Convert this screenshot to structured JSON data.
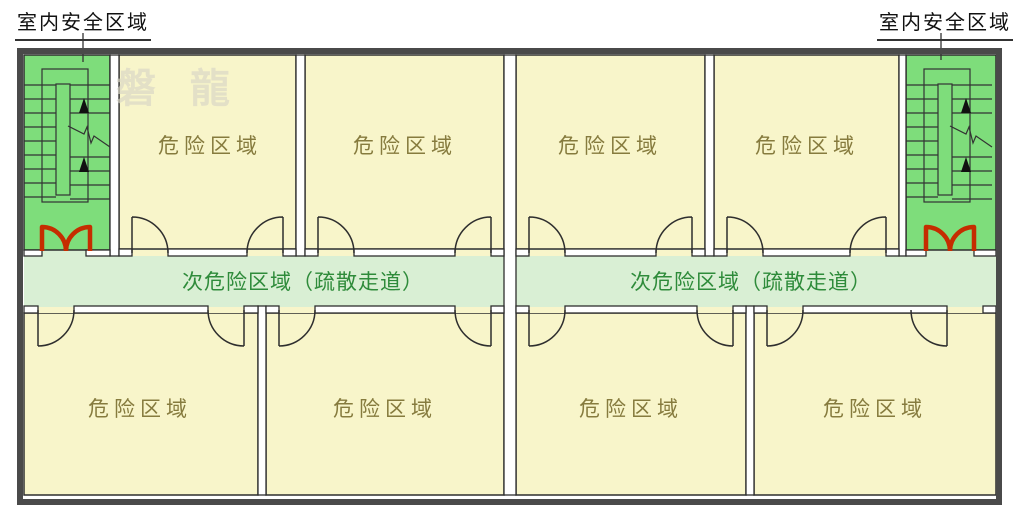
{
  "diagram": {
    "type": "evacuation-floor-plan",
    "watermark": "磐 龍",
    "safe_zone_labels": {
      "left": "室内安全区域",
      "right": "室内安全区域"
    },
    "corridor": {
      "left_label": "次危险区域（疏散走道）",
      "right_label": "次危险区域（疏散走道）"
    },
    "rooms": {
      "top": [
        "危险区域",
        "危险区域",
        "危险区域",
        "危险区域"
      ],
      "bottom": [
        "危险区域",
        "危险区域",
        "危险区域",
        "危险区域"
      ]
    },
    "colors": {
      "room_fill": "#f8f5ca",
      "stairwell_fill": "#7edd7b",
      "corridor_fill": "#d9efd4",
      "outer_wall": "#4a4a4a",
      "inner_line": "#2e2e2e",
      "fire_door_red": "#c52d00",
      "room_text": "#867b3e",
      "corridor_text": "#2e8b3a",
      "label_text": "#111111",
      "watermark_text": "#d9d6c6"
    }
  }
}
